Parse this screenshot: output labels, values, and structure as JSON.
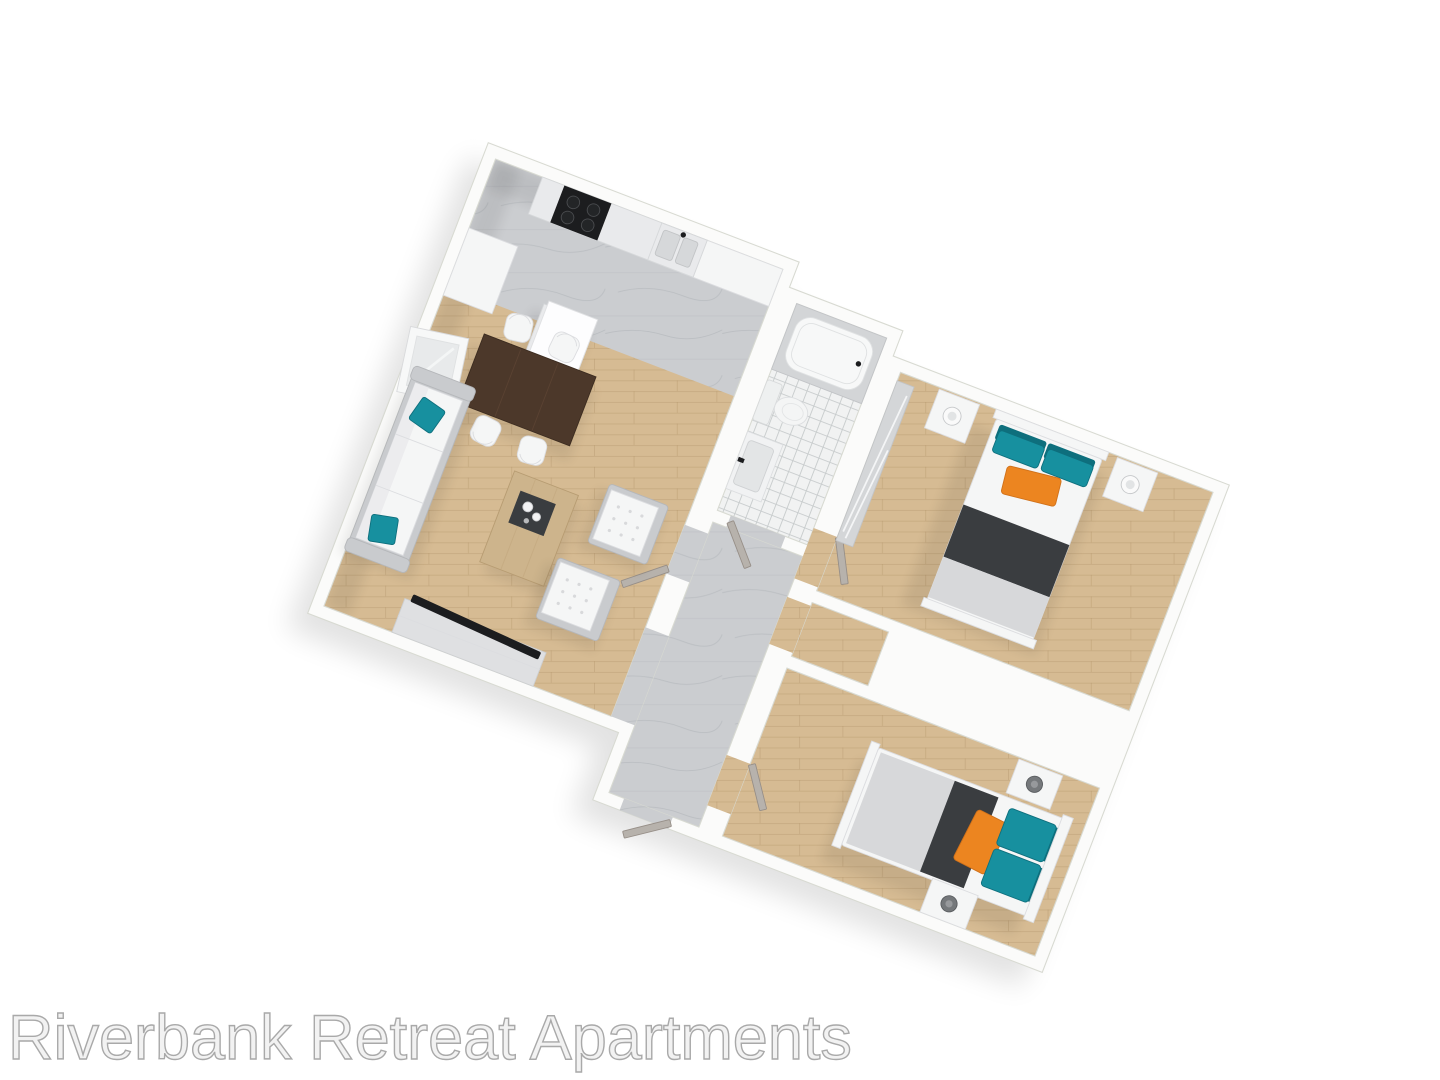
{
  "watermark": {
    "text": "Riverbank Retreat Apartments"
  },
  "palette": {
    "background": "#ffffff",
    "wall_white": "#fbfbfa",
    "wall_edge": "#d8dad2",
    "floor_wood": "#d6bb93",
    "floor_wood_line": "#a98a5e",
    "floor_marble": "#cbcdd0",
    "floor_marble_vein": "#b7babe",
    "bath_tile": "#f1f2f2",
    "bath_tile_line": "#c7cbcc",
    "accent_teal": "#17909f",
    "accent_teal_dark": "#0e6f7d",
    "accent_orange": "#ec8520",
    "accent_orange_dark": "#d0711a",
    "blanket_dark": "#3a3d40",
    "mattress_gray": "#d7d8da",
    "furniture_white": "#f5f6f6",
    "furniture_white_edge": "#dcdde0",
    "furniture_gray": "#c9cbce",
    "wood_dark": "#4c382a",
    "wood_light": "#cdb48c",
    "door_gray": "#b7b2ac",
    "door_gray_edge": "#978f88",
    "appliance_black": "#1c1d1f",
    "watermark_fill": "#f2f2f2",
    "watermark_edge": "#a9a9a9"
  }
}
